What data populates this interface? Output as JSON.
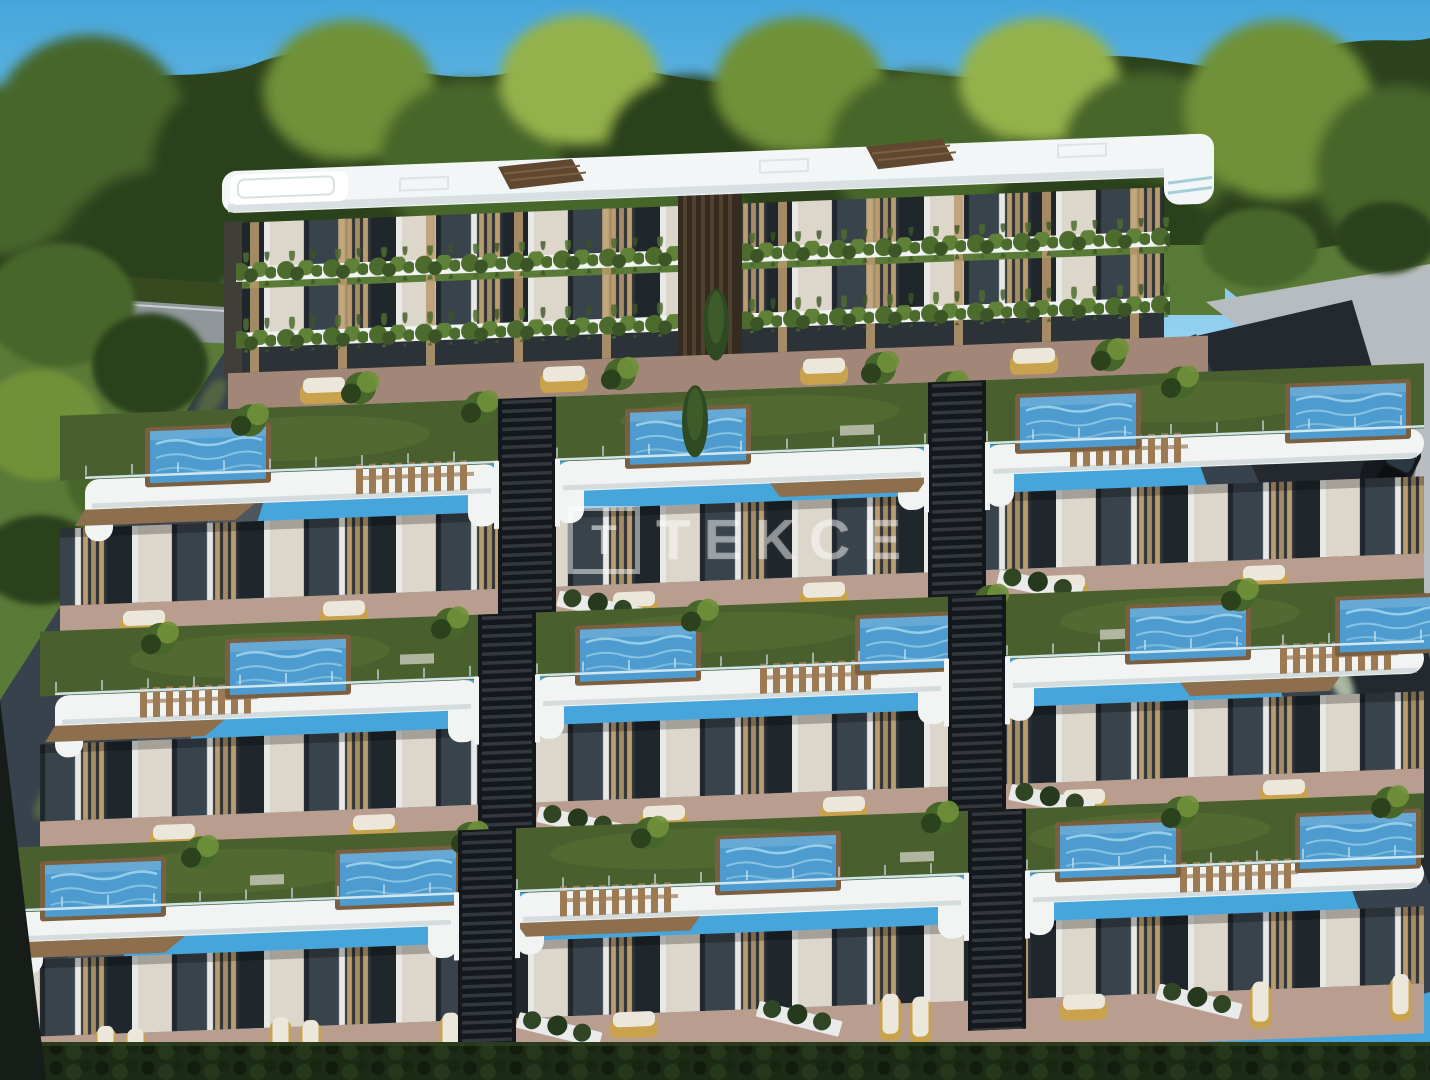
{
  "scene": {
    "description": "Aerial 3D architectural rendering of a terraced apartment complex: a three-storey top block with planted balconies and stepped rooftop-garden terraces below, each with lawns, private plunge pools, glass railings, pergolas and wicker loungers; dense trees above, a light road on the left, a dark asphalt road with one car on the right",
    "watermark": {
      "logo_letter": "T",
      "text": "TEKCE"
    },
    "counts": {
      "top_block_floors": 3,
      "terrace_rows": 3,
      "cars_on_road": 1
    },
    "palette": {
      "sky_top": "#46a6dc",
      "sky_bottom": "#a8dbf4",
      "tree_base": "#2c421d",
      "tree_mid": "#47662a",
      "tree_light": "#6f9138",
      "tree_lighter": "#94b24c",
      "lawn": "#5a7a38",
      "lawn_dark": "#36491f",
      "road_left": "#8f979b",
      "curb": "#b6bcbf",
      "asphalt": "#23292f",
      "dash": "#cfe8f4",
      "wall": "#38424d",
      "vine": "#5b7040",
      "walkway": "#4e565e",
      "roof": "#f3f6f6",
      "roof_shadow": "#d9e0e3",
      "fascia": "#f1f4f3",
      "fascia_shadow": "#c3ccd0",
      "soffit": "#8d6f4e",
      "facade": "#2b3238",
      "curtain": "#ddd7cb",
      "glass_dark": "#1f262c",
      "slat": "#bb9c6f",
      "grass": "#49602e",
      "grass_light": "#5d7838",
      "patio": "#b99e90",
      "patio_dark": "#a28778",
      "pool": "#4e9bcf",
      "pool_light": "#9fd4ea",
      "wood_dark": "#7b5f41",
      "rail": "#d6ebf2",
      "pergola": "#9b7a54",
      "wicker": "#c9a24e",
      "cushion": "#ece7db",
      "stair": "#14181c",
      "step": "#343b42",
      "hedge": "#1d2a16",
      "hedge_dark": "#131d0e",
      "plant": "#4c6c2e",
      "sign": "#c8a24a",
      "car_body": "#14181d",
      "taillight": "#c23428"
    }
  }
}
